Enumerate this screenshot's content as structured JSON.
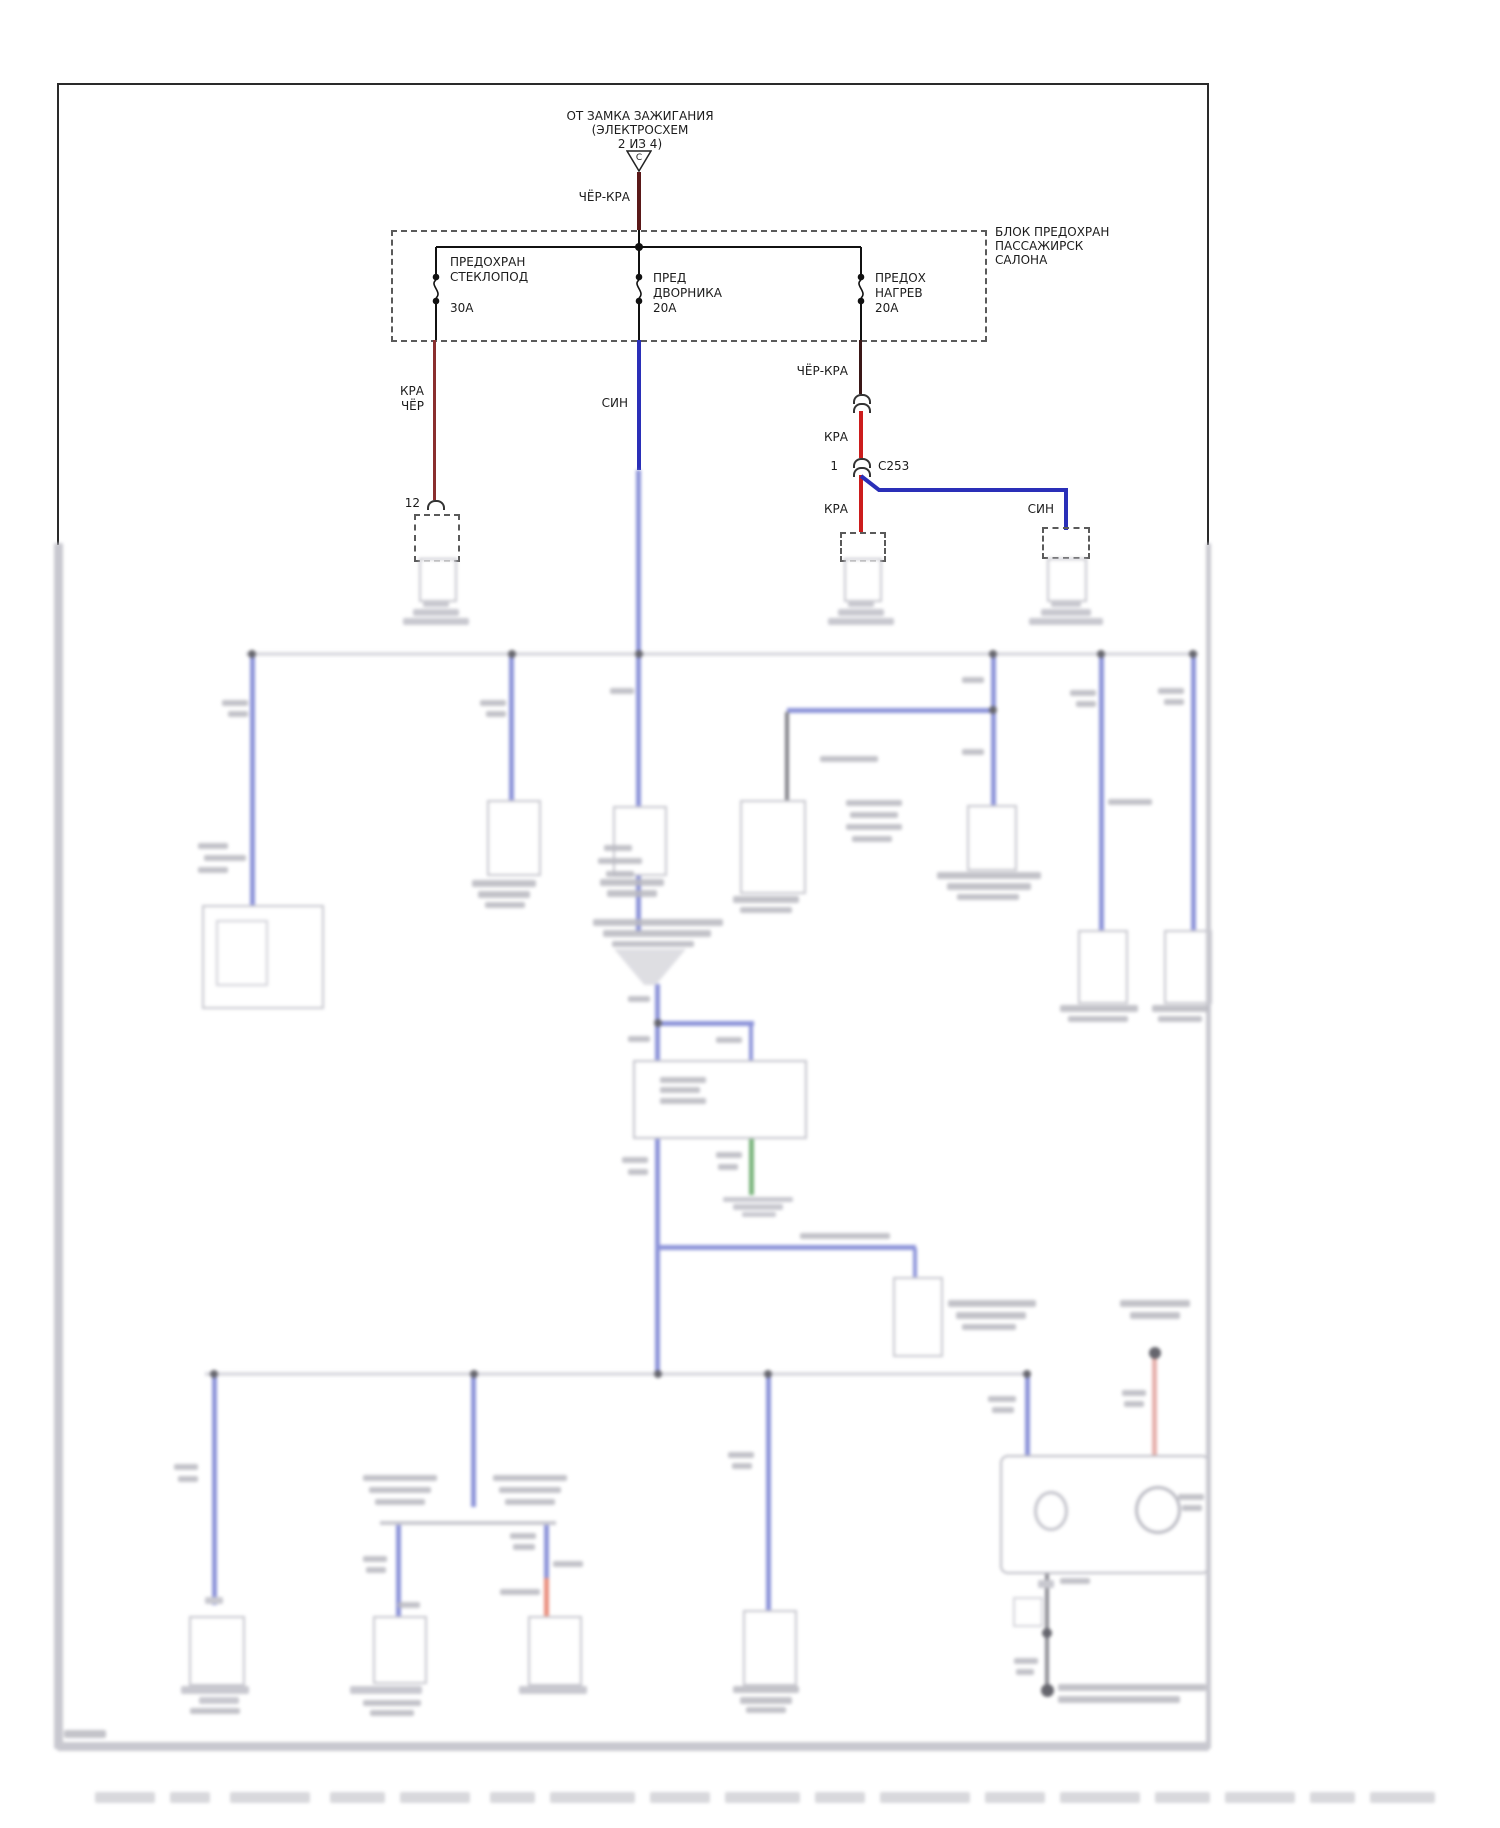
{
  "colors": {
    "wire_blue": "#2a2fb8",
    "wire_red": "#cc1c1c",
    "wire_dark_red": "#8a2f2f",
    "wire_black_red": "#3a1717",
    "wire_green": "#55a058",
    "wire_orange": "#e4705a",
    "wire_salmon": "#e09a94",
    "schematic_line": "#222222"
  },
  "source": {
    "note_line1": "ОТ ЗАМКА ЗАЖИГАНИЯ",
    "note_line2": "(ЭЛЕКТРОСХЕМ",
    "note_line3": "2 ИЗ 4)",
    "connector_letter": "C",
    "wire_label": "ЧЁР-КРА"
  },
  "fuse_block": {
    "title_line1": "БЛОК ПРЕДОХРАН",
    "title_line2": "ПАССАЖИРСК",
    "title_line3": "САЛОНА",
    "fuses": [
      {
        "name_line1": "ПРЕДОХРАН",
        "name_line2": "СТЕКЛОПОД",
        "rating": "30А"
      },
      {
        "name_line1": "ПРЕД",
        "name_line2": "ДВОРНИКА",
        "rating": "20А"
      },
      {
        "name_line1": "ПРЕДОХ",
        "name_line2": "НАГРЕВ",
        "rating": "20А"
      }
    ]
  },
  "branches": {
    "left": {
      "wire_line1": "КРА",
      "wire_line2": "ЧЁР",
      "pin": "12"
    },
    "center": {
      "wire_label": "СИН"
    },
    "right": {
      "upper_wire_label": "ЧЁР-КРА",
      "mid_wire_label": "КРА",
      "pin": "1",
      "connector": "С253",
      "branch_red_label": "КРА",
      "branch_blue_label": "СИН"
    }
  }
}
